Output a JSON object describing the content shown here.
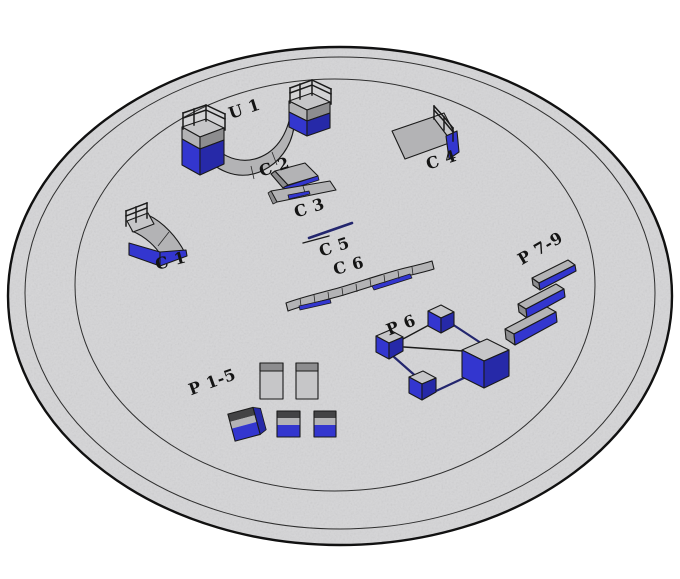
{
  "diagram": {
    "title": "Skatepark obstacle layout on a circular pad (3D view)",
    "view": "isometric-3d",
    "background": "#ffffff",
    "colors": {
      "pad": "#d5d5d7",
      "outline": "#1a1a1a",
      "grey": "#b3b3b5",
      "greyLight": "#c6c6c8",
      "greyDark": "#8d8d8f",
      "band": "#434345",
      "blue": "#3336cf",
      "blueDark": "#2629a8",
      "navy": "#23266e",
      "label": "#141414"
    },
    "platform": {
      "shape": "circular pad",
      "rings": 3
    },
    "labels": {
      "u1": "U 1",
      "c1": "C 1",
      "c2": "C 2",
      "c3": "C 3",
      "c4": "C 4",
      "c5": "C 5",
      "c6": "C 6",
      "p6": "P 6",
      "p79": "P 7-9",
      "p15": "P 1-5"
    },
    "elements": [
      {
        "id": "U1",
        "label": "U 1",
        "kind": "halfpipe with railed platforms",
        "position": "top center"
      },
      {
        "id": "C1",
        "label": "C 1",
        "kind": "quarter pipe with railing",
        "position": "left"
      },
      {
        "id": "C2",
        "label": "C 2",
        "kind": "bank ramp",
        "position": "center"
      },
      {
        "id": "C3",
        "label": "C 3",
        "kind": "bank ramp",
        "position": "center"
      },
      {
        "id": "C4",
        "label": "C 4",
        "kind": "bank ramp with railing",
        "position": "upper right"
      },
      {
        "id": "C5",
        "label": "C 5",
        "kind": "flat rail",
        "position": "center"
      },
      {
        "id": "C6",
        "label": "C 6",
        "kind": "segmented snake ledge",
        "position": "center"
      },
      {
        "id": "P6",
        "label": "P 6",
        "kind": "four blocks linked by rails",
        "position": "lower right"
      },
      {
        "id": "P7-9",
        "label": "P 7-9",
        "kind": "three parallel ledges",
        "position": "right"
      },
      {
        "id": "P1-5",
        "label": "P 1-5",
        "kind": "two tall boxes and three cubes",
        "position": "lower left"
      }
    ]
  }
}
